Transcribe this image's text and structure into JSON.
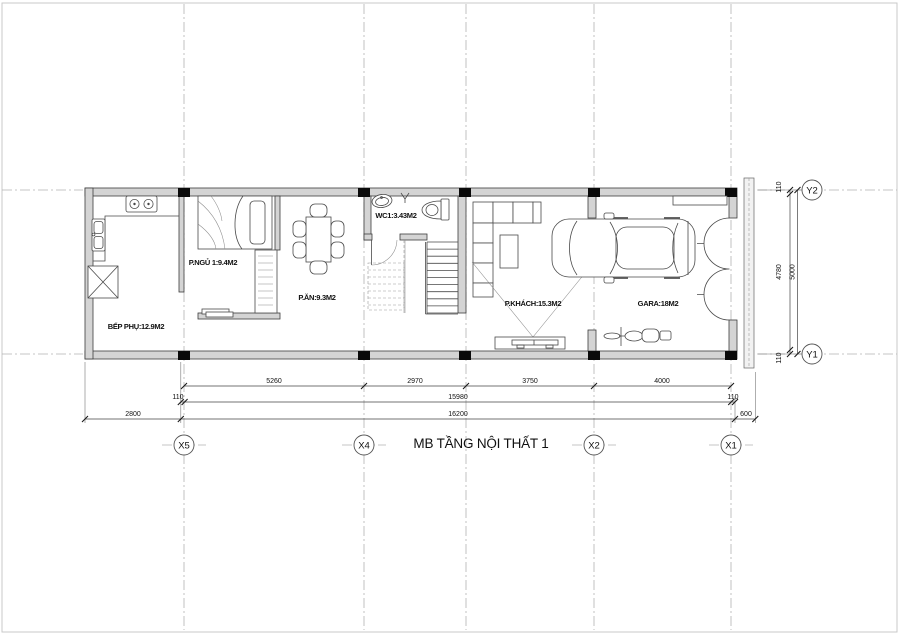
{
  "title": "MB TẦNG NỘI THẤT 1",
  "rooms": {
    "kitchen": "BẾP PHỤ:12.9M2",
    "bedroom": "P.NGỦ 1:9.4M2",
    "dining": "P.ĂN:9.3M2",
    "wc": "WC1:3.43M2",
    "living": "P.KHÁCH:15.3M2",
    "garage": "GARA:18M2"
  },
  "axes": {
    "x5": "X5",
    "x4": "X4",
    "x2": "X2",
    "x1": "X1",
    "y2": "Y2",
    "y1": "Y1"
  },
  "dims": {
    "seg1": "5260",
    "seg2": "2970",
    "seg3": "3750",
    "seg4": "4000",
    "off_l": "110",
    "span": "15980",
    "off_r": "110",
    "left_ext": "2800",
    "total": "16200",
    "right_ext": "600",
    "v_off_t": "110",
    "v_span": "4780",
    "v_off_b": "110",
    "v_total": "5000"
  }
}
